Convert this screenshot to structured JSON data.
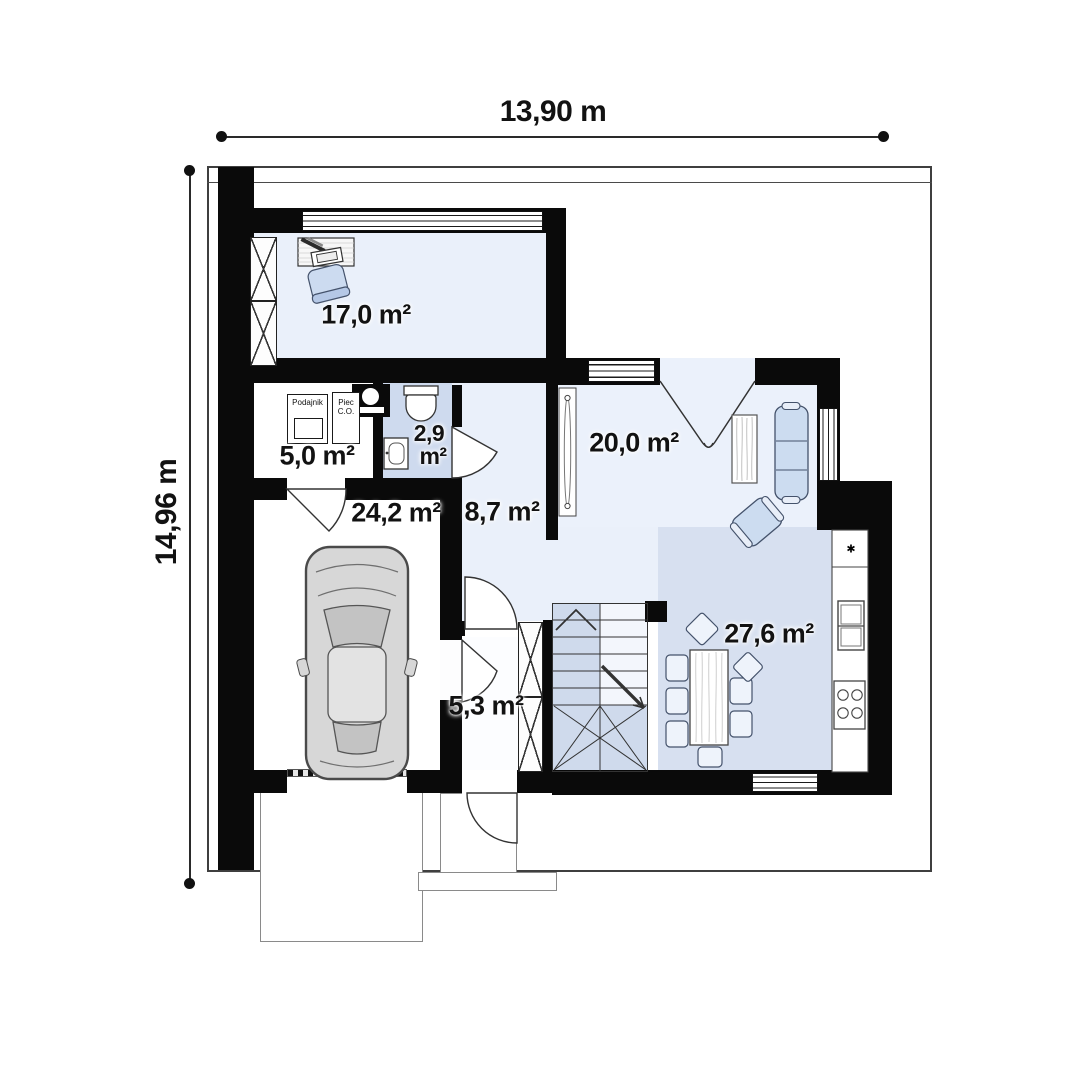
{
  "plan": {
    "title": "house-ground-floor-plan",
    "dimensions": {
      "top": "13,90 m",
      "left": "14,96 m"
    },
    "rooms": {
      "office": "17,0 m²",
      "boiler": "5,0 m²",
      "bath_line1": "2,9",
      "bath_line2": "m²",
      "garage": "24,2 m²",
      "hall": "8,7 m²",
      "living": "20,0 m²",
      "kitchen": "27,6 m²",
      "entry": "5,3 m²"
    },
    "equipment": {
      "feeder": "Podajnik",
      "furnace_line1": "Piec",
      "furnace_line2": "C.O.",
      "fridge_mark": "✱"
    },
    "colors": {
      "wall": "#0a0a0a",
      "floor_light": "#eaf0fa",
      "floor_mid": "#cfdaec",
      "floor_dark": "#d7e0f0",
      "furniture_blue": "#ccdcf0"
    }
  }
}
